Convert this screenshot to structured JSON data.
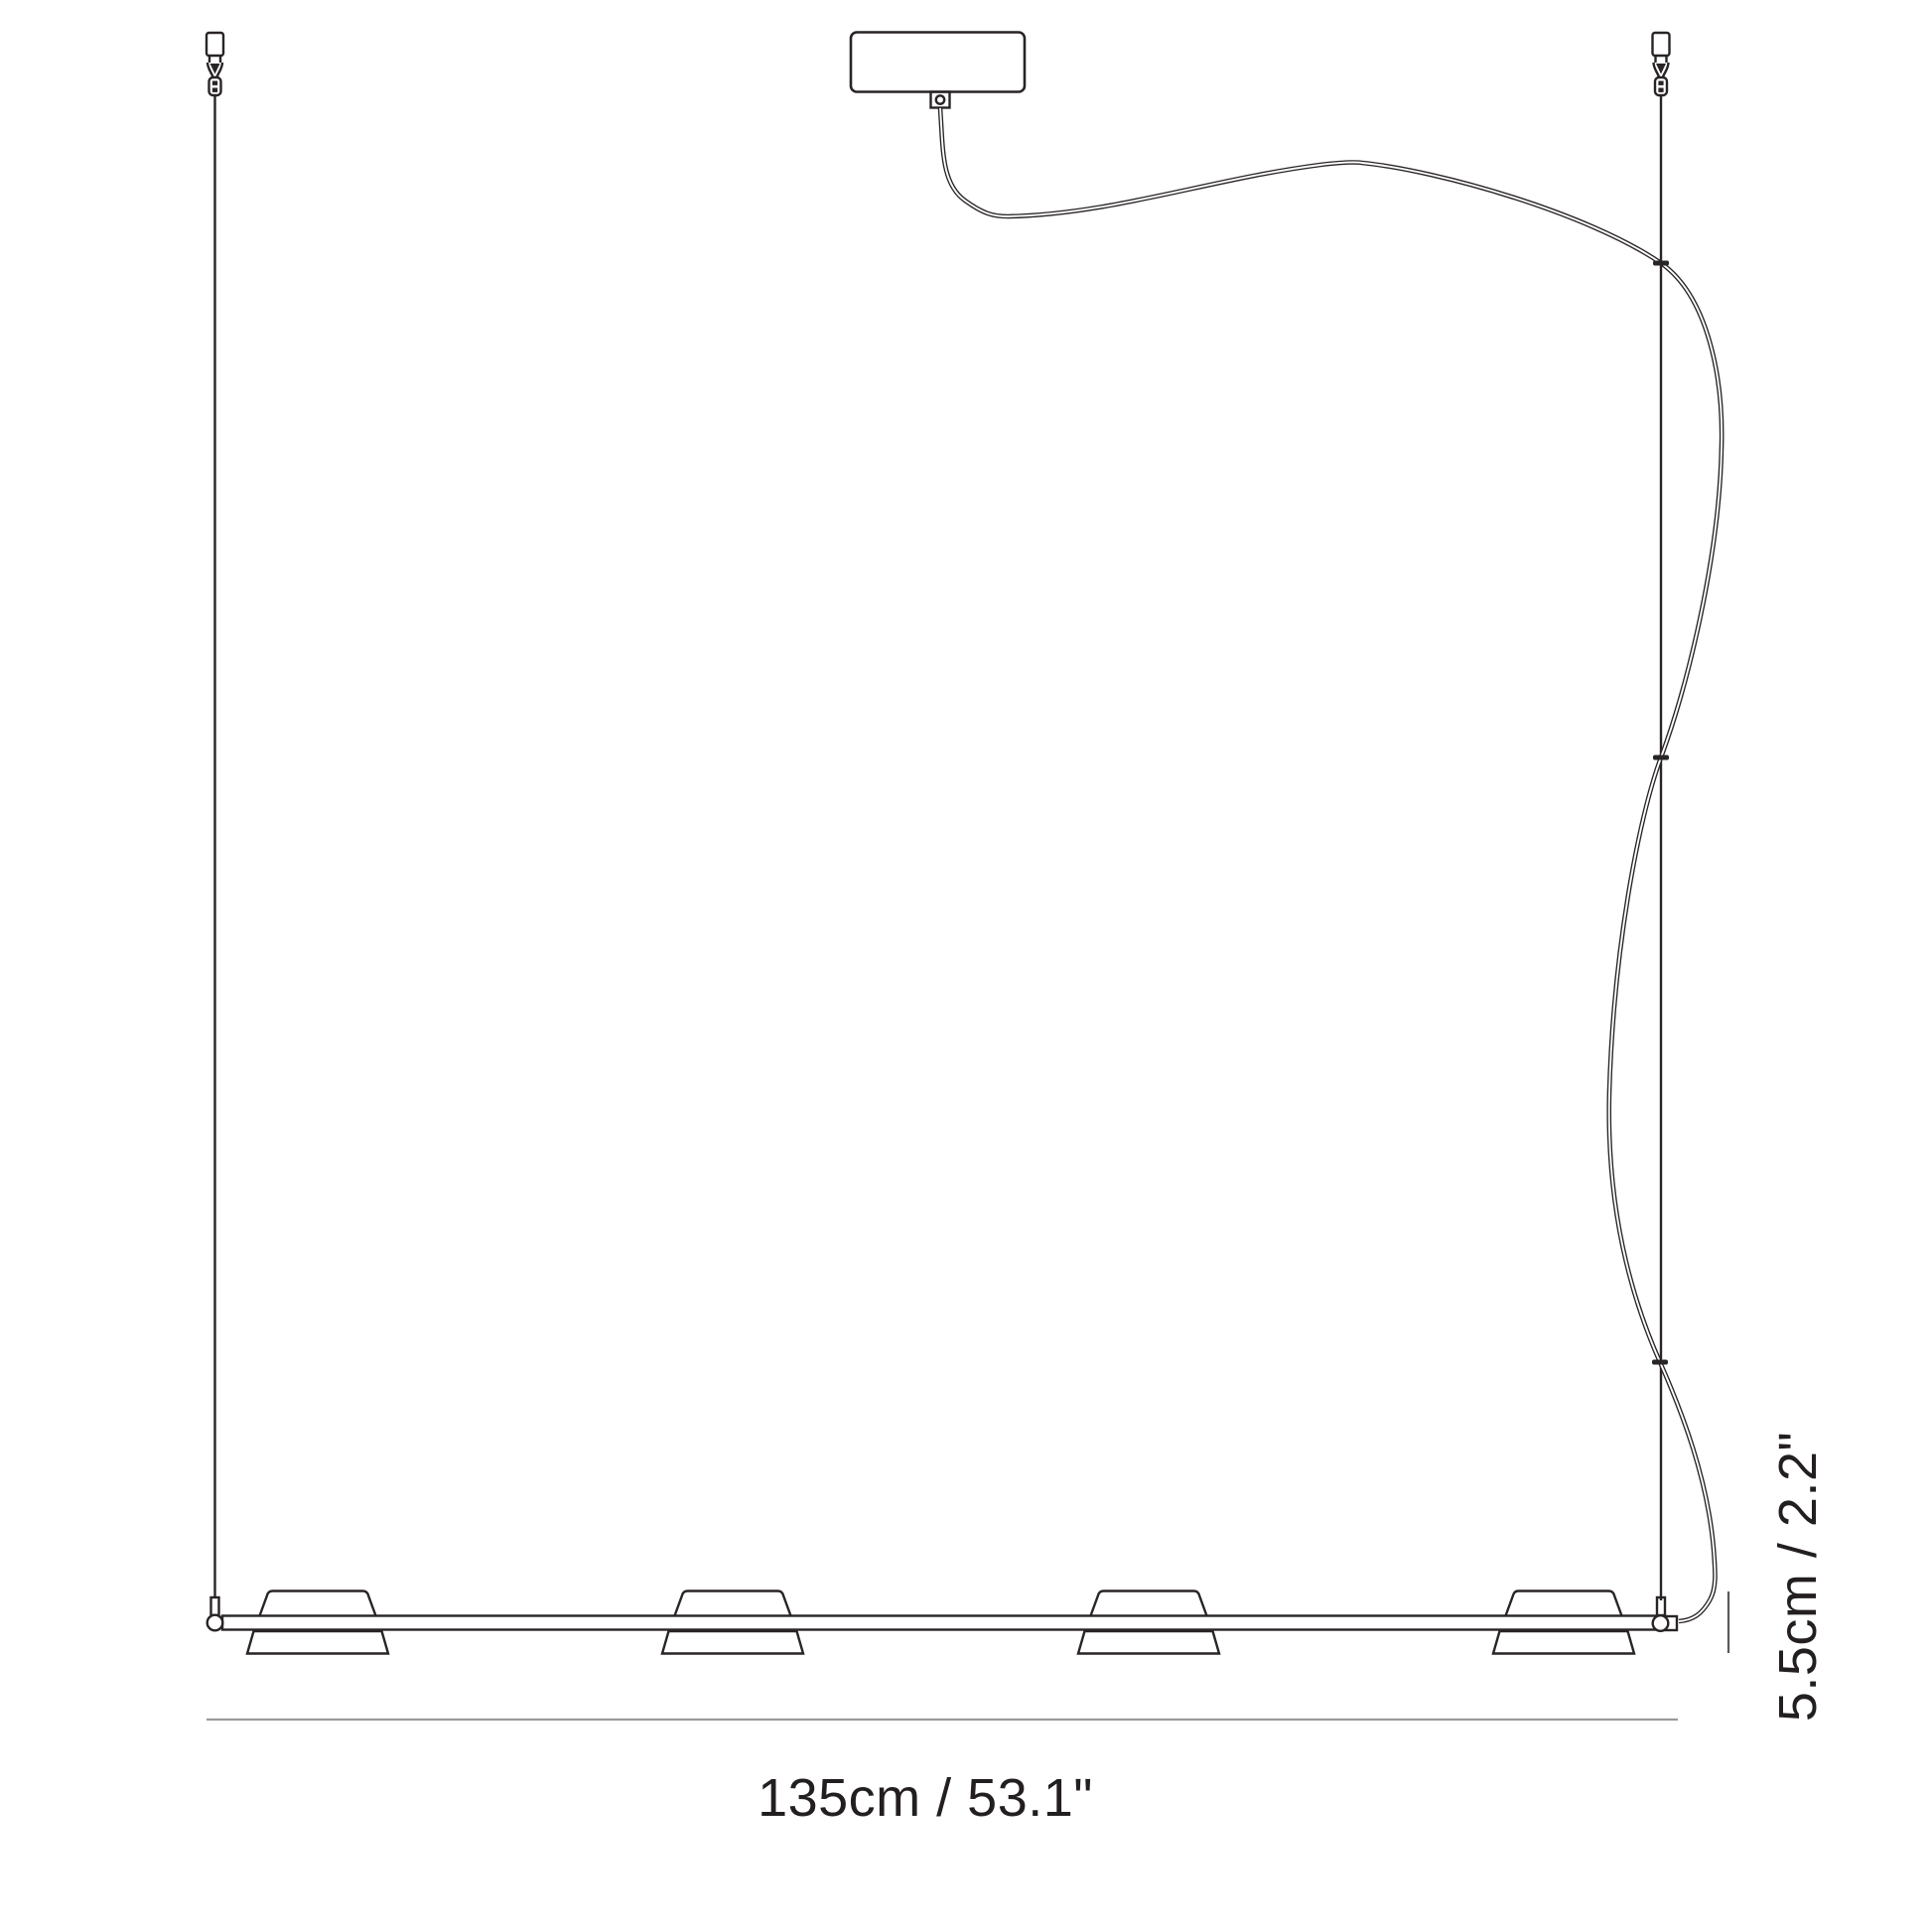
{
  "diagram": {
    "name": "linear-pendant-light-dimension-drawing",
    "background": "#ffffff",
    "colors": {
      "line": "#292425",
      "cord": "#292425",
      "dim_h": "#9a9a9a",
      "dim_v": "#5a5a5a",
      "text": "#231f20",
      "fill": "#ffffff"
    },
    "dimension_labels": {
      "width": "135cm / 53.1\"",
      "height": "5.5cm / 2.2\""
    },
    "parts": [
      "ceiling-anchor-left",
      "ceiling-anchor-right",
      "suspension-cable-left",
      "suspension-cable-right",
      "ceiling-canopy",
      "canopy-cable-gland",
      "power-cord",
      "cord-clip",
      "fixture-bar",
      "lamp-shade",
      "end-cap-left",
      "end-cap-right",
      "width-dimension-line",
      "height-dimension-line"
    ]
  }
}
